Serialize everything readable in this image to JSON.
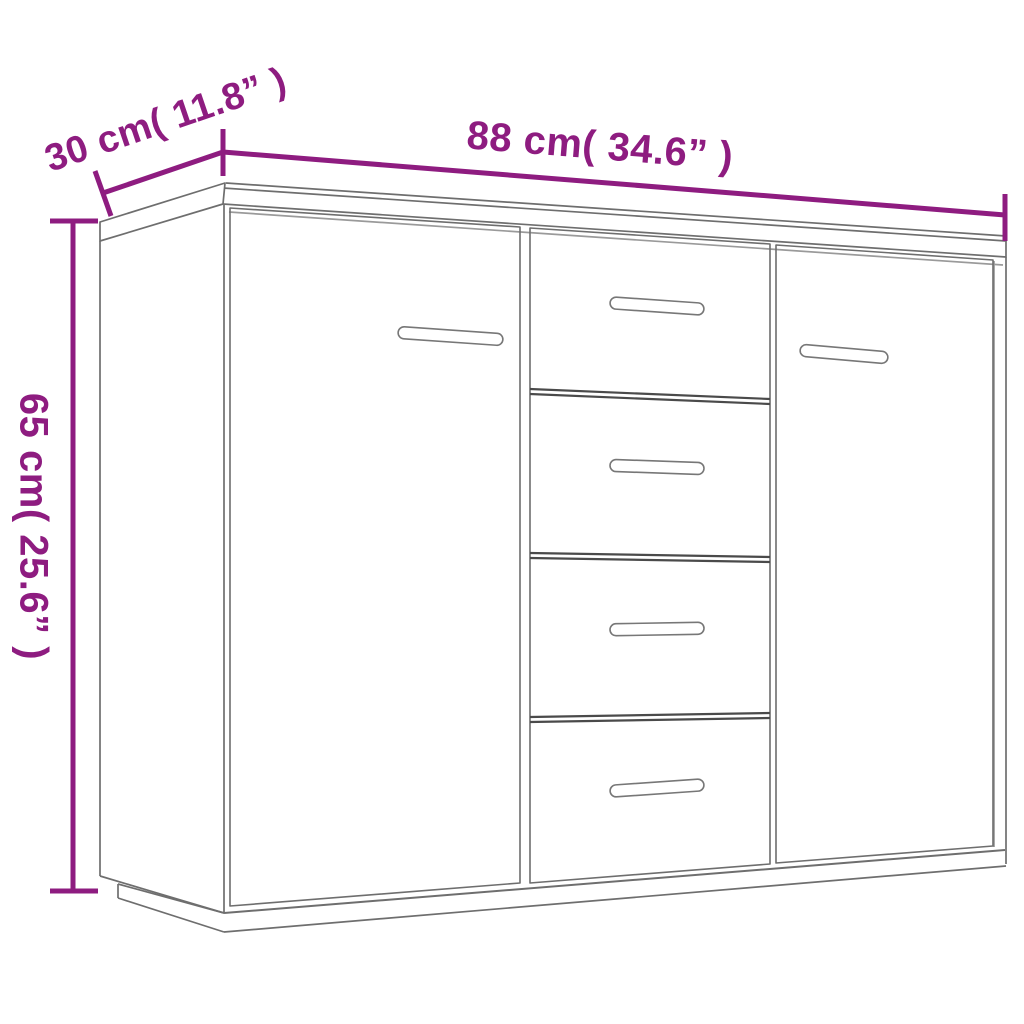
{
  "diagram": {
    "kind": "product-dimension-diagram",
    "product": "sideboard with 2 doors and 4 drawers",
    "background_color": "#ffffff",
    "accent_color": "#8E1C80",
    "outline_color": "#6e6e6e",
    "dimensions": {
      "width": {
        "label": "88 cm( 34.6” )",
        "cm": 88,
        "inches": 34.6
      },
      "depth": {
        "label": "30 cm( 11.8” )",
        "cm": 30,
        "inches": 11.8
      },
      "height": {
        "label": "65 cm( 25.6” )",
        "cm": 65,
        "inches": 25.6
      }
    }
  }
}
